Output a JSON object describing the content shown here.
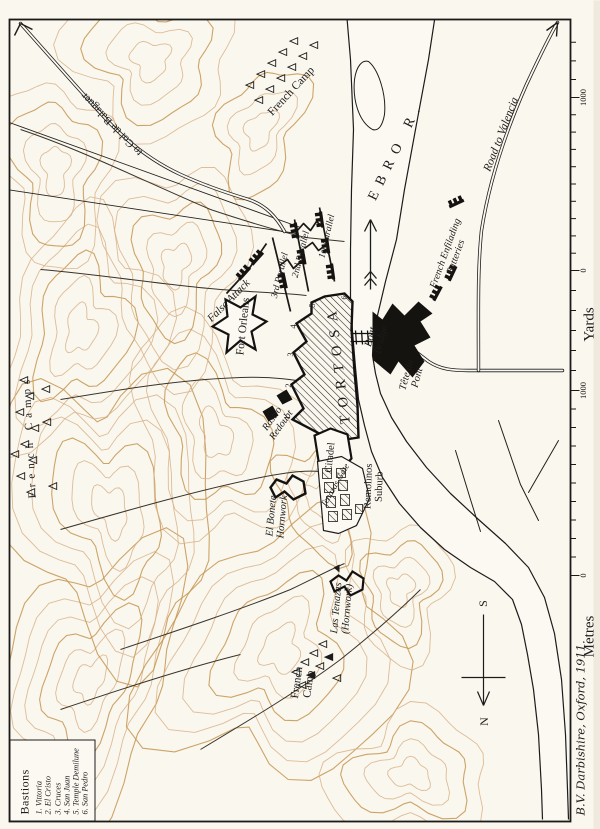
{
  "legend": {
    "heading": "Bastions",
    "items": [
      "1. Vittoria",
      "2. El Cristo",
      "3. Cruces",
      "4. San Juan",
      "5. Temple Demilune",
      "6. San Pedro"
    ]
  },
  "labels": {
    "balaguer": "to Col de Balaguer",
    "french_camp_ne": "French Camp",
    "ebro": "EBRO R.",
    "road_valencia": "Road to Valencia",
    "enfilading": "French Enfilading\nBatteries",
    "parallel1": "1st Parallel",
    "parallel2": "2nd Parallel",
    "parallel3": "3rd Parallel",
    "false_attack": "False Attack",
    "fort_orleans": "Fort Orleans",
    "tortosa": "TORTOSA",
    "boat_bridge": "Boat\nBridge",
    "tete_du_pont": "Tête du\nPont",
    "citadel": "Citadel",
    "tenazas_gate": "Tenazas Gate",
    "remolinos": "Remolinos\nSuburb",
    "rastro": "Rastro\nRedoubt",
    "el_bonete": "El Bonete\nHornwork",
    "las_tenazas": "Las Tenazas\n(Hornwork)",
    "french_camp_s": "French\nCamp",
    "french_camps_w": "French Camps"
  },
  "bastion_numbers": [
    "1",
    "2",
    "3",
    "4",
    "5",
    "6"
  ],
  "scales": {
    "yards": {
      "name": "Yards",
      "zero": "0",
      "max": "1000"
    },
    "metres": {
      "name": "Metres",
      "zero": "0",
      "max": "1000"
    }
  },
  "compass": {
    "north": "N",
    "south": "S"
  },
  "credit": "B.V. Darbishire, Oxford, 1911.",
  "colors": {
    "paper": "#faf7ef",
    "ink": "#1d1c1a",
    "contour": "#d8b286",
    "contour_dark": "#c4954f"
  }
}
